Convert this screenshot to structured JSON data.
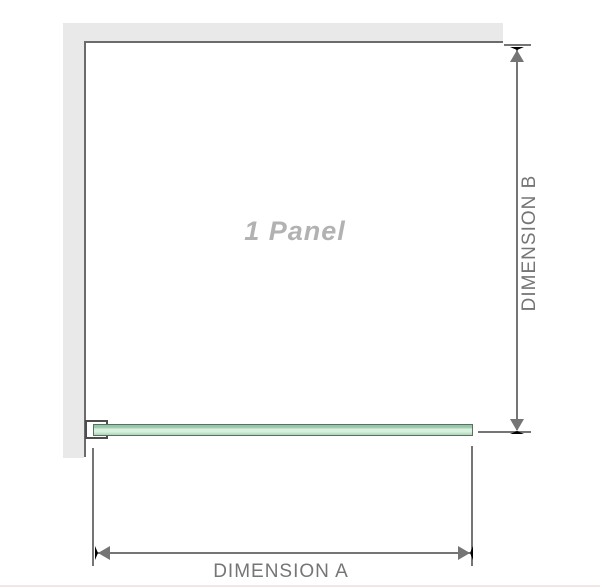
{
  "diagram": {
    "panel_label": "1 Panel",
    "dimension_a_label": "DIMENSION A",
    "dimension_b_label": "DIMENSION B"
  },
  "colors": {
    "wall": "#e9e9e9",
    "edge_line": "#6b6b6b",
    "dimension": "#757575",
    "panel_label_text": "#b2b2b2",
    "glass_border": "#5d6f62",
    "glass_light": "#d8f1de",
    "glass_medium": "#96c8a8",
    "glass_shadow": "#a8d4b4",
    "bracket_border": "#4d4d4d",
    "footer_line": "#f3e6e6"
  }
}
